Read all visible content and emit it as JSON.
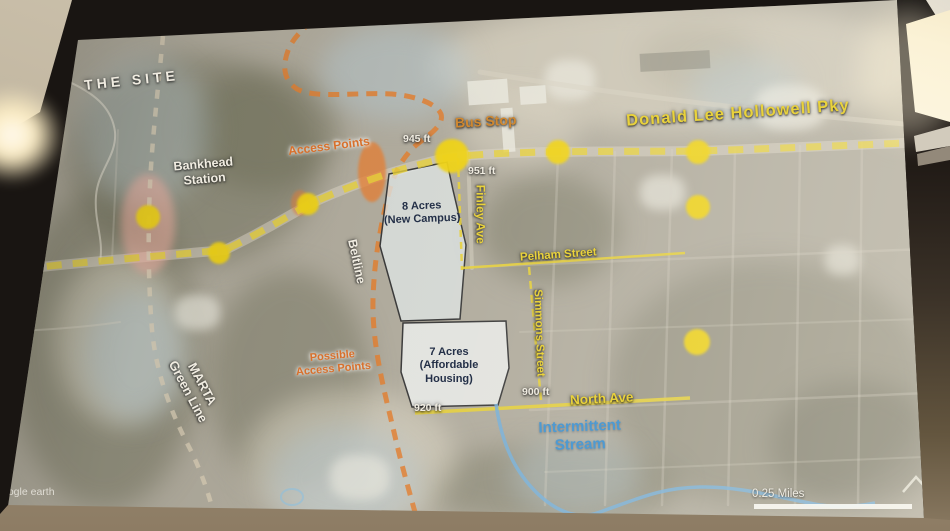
{
  "room": {
    "description": "conference room: projection screen with dark bezel, beige ceiling, glowing wall sconce lamps on both sides, tan wall below screen"
  },
  "map": {
    "watermark": "oogle earth",
    "scale_label": "0.25 Miles",
    "labels": {
      "site": "THE SITE",
      "station_1": "Bankhead",
      "station_2": "Station",
      "access_points": "Access Points",
      "elev_945": "945 ft",
      "bus_stop": "Bus Stop",
      "parkway": "Donald Lee Hollowell Pky",
      "elev_951": "951 ft",
      "finley": "Finley Ave",
      "campus_1": "8 Acres",
      "campus_2": "(New Campus)",
      "beltline": "Beltline",
      "marta_1": "MARTA",
      "marta_2": "Green Line",
      "possible_1": "Possible",
      "possible_2": "Access Points",
      "pelham": "Pelham Street",
      "simmons": "Simmons Street",
      "housing_1": "7 Acres",
      "housing_2": "(Affordable",
      "housing_3": "Housing)",
      "elev_900": "900 ft",
      "elev_920": "920 ft",
      "north_ave": "North Ave",
      "stream_1": "Intermittent",
      "stream_2": "Stream"
    },
    "markers": {
      "access_point_count": 8,
      "marker_color": "#efd216",
      "largest_marker": "bus stop intersection"
    },
    "colors": {
      "road_dashed_yellow": "#e6cf3a",
      "beltline_dashed_orange": "#df7f33",
      "stream_blue": "#74aed8",
      "station_highlight_pink": "#f4b0a2",
      "label_yellow": "#e9d23c",
      "label_orange": "#d8702c",
      "label_blue": "#4e9ad2",
      "parcel_fill": "#e6eae8"
    }
  }
}
